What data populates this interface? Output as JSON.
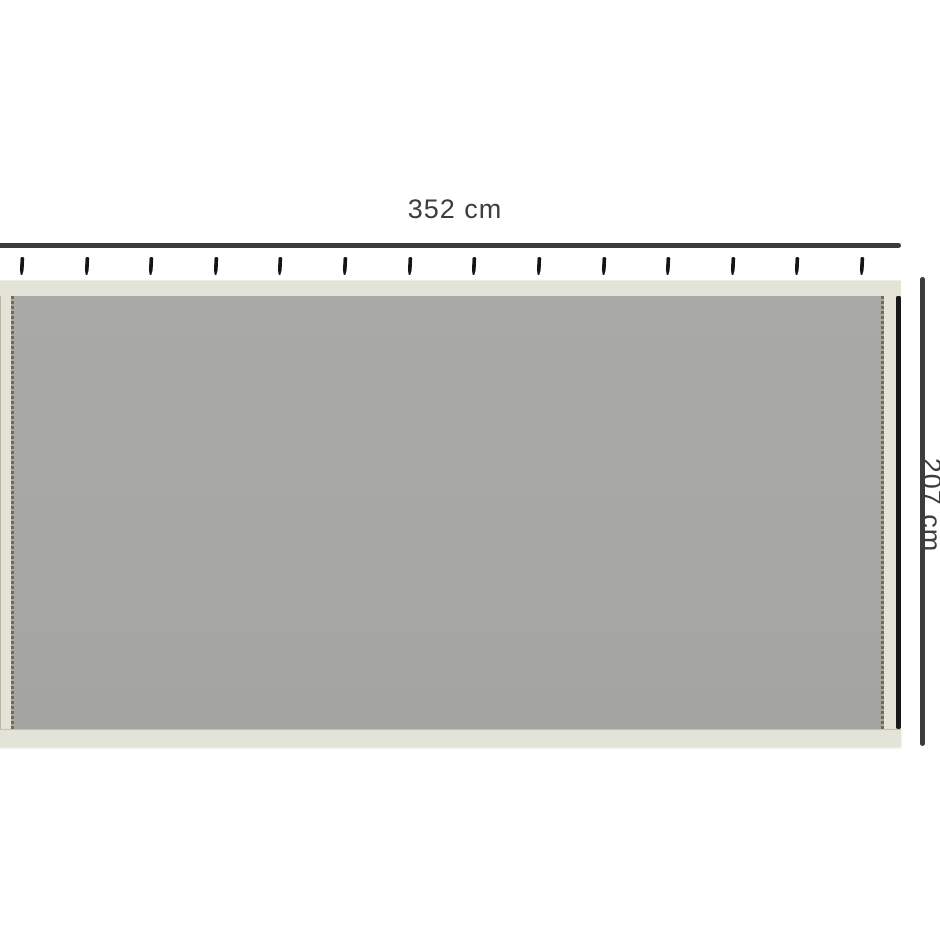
{
  "diagram": {
    "width_label": "352 cm",
    "height_label": "207 cm"
  },
  "panel": {
    "hook_count": 14,
    "hook_icon_name": "curtain-hook-icon"
  },
  "colors": {
    "background": "#ffffff",
    "fabric": "#a7a7a5",
    "trim": "#e4e3d7",
    "dimension_line": "#3a3d40",
    "hook": "#141414",
    "edge_stripe": "#181818",
    "label_text": "#3d3d3d"
  }
}
